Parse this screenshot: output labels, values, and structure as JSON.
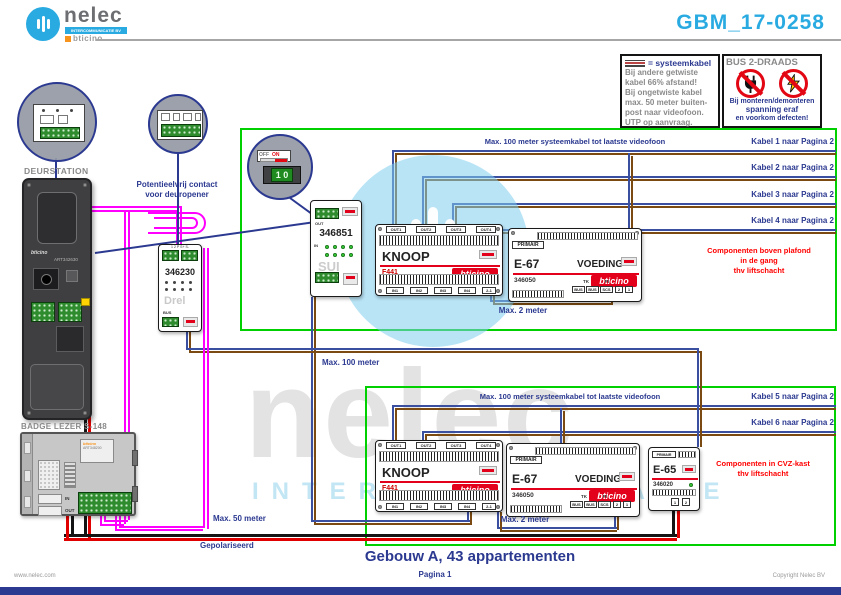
{
  "header": {
    "brand": "nelec",
    "brand_sub": "INTERCOMMUNICATIE BV",
    "partner": "bticino",
    "doc_number": "GBM_17-0258"
  },
  "legend_box": {
    "title": "= systeemkabel",
    "lines": [
      "Bij andere getwiste",
      "kabel 66% afstand!",
      "Bij ongetwiste kabel",
      "max. 50 meter buiten-",
      "post naar videofoon.",
      "UTP op aanvraag."
    ]
  },
  "bus_box": {
    "title": "BUS 2-DRAADS",
    "lines": [
      "Bij monteren/demonteren",
      "spanning eraf",
      "en voorkom defecten!"
    ]
  },
  "top_zone": {
    "max_label": "Max. 100 meter systeemkabel tot laatste videofoon",
    "cables": [
      "Kabel 1 naar Pagina 2",
      "Kabel 2 naar Pagina 2",
      "Kabel 3 naar Pagina 2",
      "Kabel 4 naar Pagina 2"
    ],
    "note": [
      "Componenten boven plafond",
      "in de gang",
      "thv liftschacht"
    ],
    "max2_label": "Max. 2 meter"
  },
  "bottom_zone": {
    "max_label": "Max. 100 meter systeemkabel tot laatste videofoon",
    "cables": [
      "Kabel 5 naar Pagina 2",
      "Kabel 6 naar Pagina 2"
    ],
    "note": [
      "Componenten in CVZ-kast",
      "thv liftschacht"
    ],
    "max2_label": "Max. 2 meter"
  },
  "deurstation": {
    "label": "DEURSTATION",
    "brand": "bticino",
    "art": "ART342630"
  },
  "module_346230": {
    "code": "346230",
    "pins_top": "1 2 P S+ S-",
    "nickname": "Drel",
    "pin_bus": "BUS"
  },
  "module_346851": {
    "code": "346851",
    "out": "OUT",
    "in": "IN",
    "nickname": "SUI"
  },
  "knoop": {
    "title": "KNOOP",
    "code": "F441",
    "brand": "bticino",
    "outs": [
      "OUT1",
      "OUT2",
      "OUT3",
      "OUT4"
    ],
    "ins": [
      "IN1",
      "IN2",
      "IN3",
      "IN4",
      "2-1"
    ]
  },
  "voeding": {
    "primair": "PRIMAIR",
    "title": "E-67",
    "subtitle": "VOEDING",
    "code": "346050",
    "brand": "bticino",
    "tk": "TK",
    "pi": "PI",
    "pins": [
      "BUS",
      "BUS",
      "SCS",
      "2",
      "1"
    ]
  },
  "e65": {
    "primair": "PRIMAIR",
    "title": "E-65",
    "code": "346020",
    "pins": [
      "1",
      "2"
    ]
  },
  "badge": {
    "label": "BADGE LEZER S-148",
    "brand": "bticino",
    "art": "ART348200",
    "in": "IN",
    "out": "OUT"
  },
  "callout_switch": {
    "off": "OFF",
    "on": "ON",
    "digits": "1 0"
  },
  "labels": {
    "pot_contact": [
      "Potentieelvrij contact",
      "voor deuropener"
    ],
    "max100": "Max. 100 meter",
    "max50": "Max. 50 meter",
    "gepolariseerd": "Gepolariseerd"
  },
  "footer": {
    "title": "Gebouw A, 43 appartementen",
    "page": "Pagina 1",
    "site": "www.nelec.com",
    "copyright": "Copyright Nelec BV"
  },
  "watermark": {
    "brand": "nelec",
    "sub": "INTERCOMMUNICATIE"
  },
  "colors": {
    "accent": "#29abe2",
    "navy": "#2b3990",
    "frame_green": "#00cf00",
    "note_red": "#ff0000",
    "wire_blue": "#3b4fa0",
    "wire_brown": "#7b4a12",
    "wire_magenta": "#ff00ff",
    "bticino_red": "#e2001a"
  }
}
